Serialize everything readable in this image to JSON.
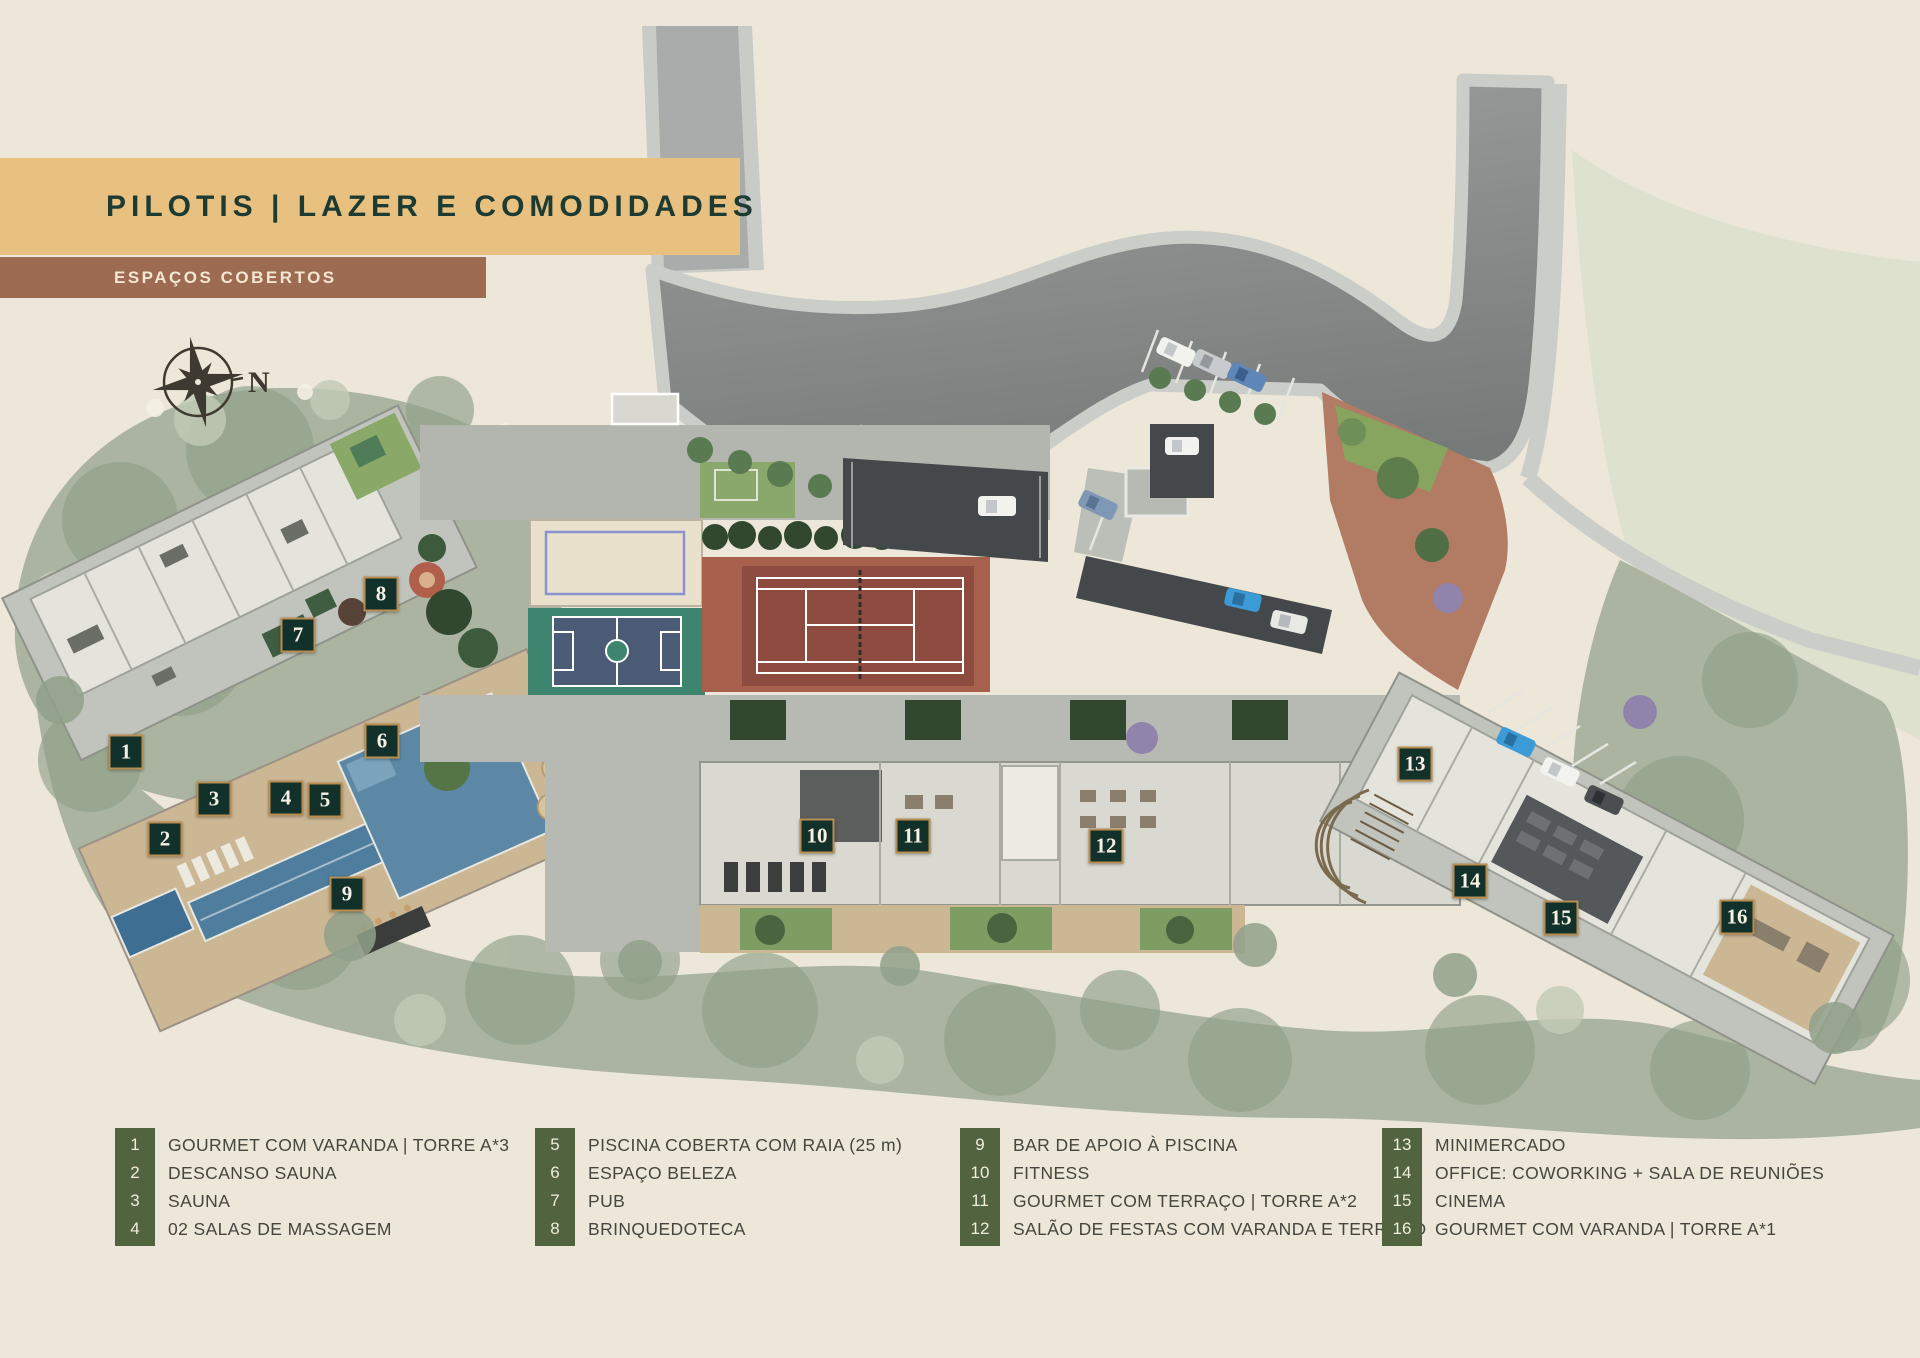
{
  "header": {
    "title": "PILOTIS | LAZER E COMODIDADES",
    "subtitle": "ESPAÇOS COBERTOS"
  },
  "compass": {
    "north_label": "N"
  },
  "legend": {
    "columns": [
      {
        "items": [
          {
            "num": "1",
            "label": "GOURMET COM VARANDA | TORRE A*3"
          },
          {
            "num": "2",
            "label": "DESCANSO SAUNA"
          },
          {
            "num": "3",
            "label": "SAUNA"
          },
          {
            "num": "4",
            "label": "02 SALAS DE MASSAGEM"
          }
        ]
      },
      {
        "items": [
          {
            "num": "5",
            "label": "PISCINA COBERTA COM RAIA (25 m)"
          },
          {
            "num": "6",
            "label": "ESPAÇO BELEZA"
          },
          {
            "num": "7",
            "label": "PUB"
          },
          {
            "num": "8",
            "label": "BRINQUEDOTECA"
          }
        ]
      },
      {
        "items": [
          {
            "num": "9",
            "label": "BAR DE APOIO À PISCINA"
          },
          {
            "num": "10",
            "label": "FITNESS"
          },
          {
            "num": "11",
            "label": "GOURMET COM TERRAÇO | TORRE A*2"
          },
          {
            "num": "12",
            "label": "SALÃO DE FESTAS COM VARANDA E TERRAÇO"
          }
        ]
      },
      {
        "items": [
          {
            "num": "13",
            "label": "MINIMERCADO"
          },
          {
            "num": "14",
            "label": "OFFICE: COWORKING + SALA DE REUNIÕES"
          },
          {
            "num": "15",
            "label": "CINEMA"
          },
          {
            "num": "16",
            "label": "GOURMET COM VARANDA | TORRE A*1"
          }
        ]
      }
    ]
  },
  "plan": {
    "markers": [
      {
        "num": "1",
        "x": 126,
        "y": 752
      },
      {
        "num": "2",
        "x": 165,
        "y": 839
      },
      {
        "num": "3",
        "x": 214,
        "y": 799
      },
      {
        "num": "4",
        "x": 286,
        "y": 798
      },
      {
        "num": "5",
        "x": 325,
        "y": 800
      },
      {
        "num": "6",
        "x": 382,
        "y": 741
      },
      {
        "num": "7",
        "x": 298,
        "y": 635
      },
      {
        "num": "8",
        "x": 381,
        "y": 594
      },
      {
        "num": "9",
        "x": 347,
        "y": 894
      },
      {
        "num": "10",
        "x": 817,
        "y": 836
      },
      {
        "num": "11",
        "x": 913,
        "y": 836
      },
      {
        "num": "12",
        "x": 1106,
        "y": 846
      },
      {
        "num": "13",
        "x": 1415,
        "y": 764
      },
      {
        "num": "14",
        "x": 1470,
        "y": 881
      },
      {
        "num": "15",
        "x": 1561,
        "y": 918
      },
      {
        "num": "16",
        "x": 1737,
        "y": 917
      }
    ]
  },
  "colors": {
    "bg": "#ece7d8",
    "banner_gold": "#e8c180",
    "banner_text": "#1d3b33",
    "banner_brown": "#9c6b52",
    "banner_brown_text": "#f4e7d2",
    "legend_green": "#51633f",
    "legend_num_text": "#f1ecdc",
    "legend_label_text": "#45463f",
    "badge_bg": "#13312b",
    "badge_border": "#b98e52",
    "badge_text": "#f6f1e4",
    "road_top": "#a9acab",
    "road_edge": "#c9cbc7",
    "canopy": "#aab4a0",
    "canopy_dark": "#90a089",
    "hedge": "#31482f",
    "platform": "#c1c4bc",
    "pavement": "#b3b6ae",
    "building": "#e4e4dd",
    "deck": "#ccb795",
    "sand": "#e9e1cb",
    "pool": "#5d88a5",
    "pool_lap": "#4e7d9d",
    "pool_deep": "#3f6e93",
    "tennis": "#a7604b",
    "tennis_dark": "#8d4c3f",
    "court_green": "#3e8570",
    "court_blue": "#4b5a75",
    "plaza": "#b27b63",
    "lawn": "#87a55e",
    "garage": "#45484a",
    "compass_ink": "#3e3a31",
    "purple_tree": "#9184ac"
  }
}
